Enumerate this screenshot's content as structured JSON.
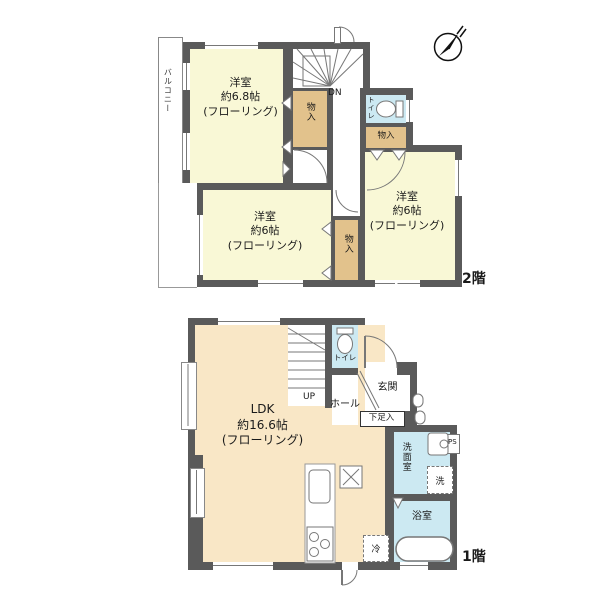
{
  "floor2": {
    "label": "2階",
    "balcony": "バルコニー",
    "stairs_dn": "DN",
    "toilet": "トイレ",
    "closet_a": "物入",
    "closet_b": "物入",
    "closet_c": "物入",
    "room_a": {
      "name": "洋室",
      "size": "約6.8帖",
      "floor": "(フローリング)"
    },
    "room_b": {
      "name": "洋室",
      "size": "約6帖",
      "floor": "(フローリング)"
    },
    "room_c": {
      "name": "洋室",
      "size": "約6帖",
      "floor": "(フローリング)"
    }
  },
  "floor1": {
    "label": "1階",
    "stairs_up": "UP",
    "toilet": "トイレ",
    "hall": "ホール",
    "entrance": "玄関",
    "shoe_box": "下足入",
    "washroom": "洗面室",
    "washer": "洗",
    "pipe_space": "PS",
    "bathroom": "浴室",
    "fridge": "冷",
    "ldk": {
      "name": "LDK",
      "size": "約16.6帖",
      "floor": "(フローリング)"
    }
  },
  "colors": {
    "wall": "#5a5a5a",
    "room_cream": "#f9f8d6",
    "room_peach": "#f9e7c6",
    "closet_tan": "#e2c28c",
    "wet_blue": "#cce9f2"
  }
}
